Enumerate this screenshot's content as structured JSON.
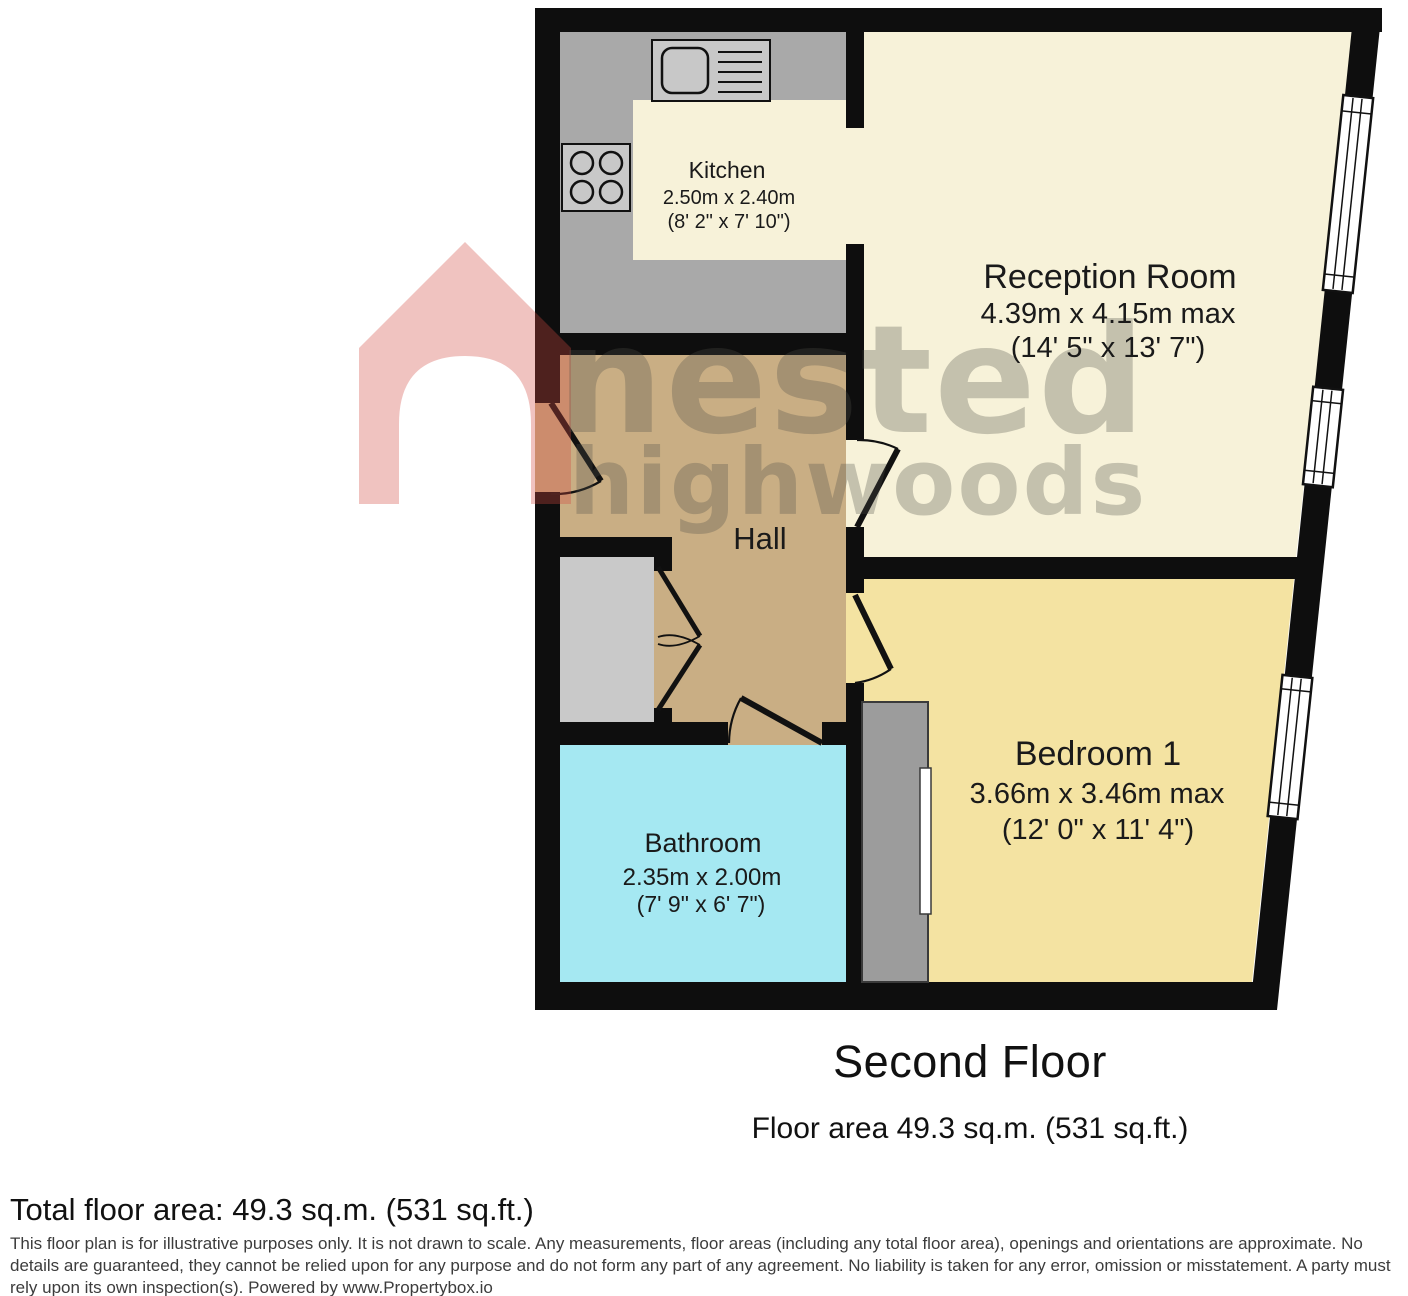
{
  "plan": {
    "rooms": {
      "kitchen": {
        "name": "Kitchen",
        "metric": "2.50m x 2.40m",
        "imperial": "(8' 2\" x 7' 10\")",
        "fill": "#f7f2d9"
      },
      "reception": {
        "name": "Reception Room",
        "metric": "4.39m x 4.15m max",
        "imperial": "(14' 5\" x 13' 7\")",
        "fill": "#f7f2d9"
      },
      "hall": {
        "name": "Hall",
        "fill": "#c9ae84"
      },
      "bedroom": {
        "name": "Bedroom 1",
        "metric": "3.66m x 3.46m max",
        "imperial": "(12' 0\" x 11' 4\")",
        "fill": "#f4e3a2"
      },
      "bathroom": {
        "name": "Bathroom",
        "metric": "2.35m x 2.00m",
        "imperial": "(7' 9\" x 6' 7\")",
        "fill": "#a5e8f2"
      }
    },
    "colors": {
      "wall": "#0e0e0e",
      "counter_gray": "#a9a9a9",
      "appliance_gray": "#c8c8c8",
      "closet_gray": "#c9c9c9",
      "wardrobe_gray": "#9c9c9c",
      "watermark_red": "#d14941",
      "watermark_gray": "#50504a"
    }
  },
  "watermark": {
    "line1": "nested",
    "line2": "highwoods"
  },
  "footer": {
    "title": "Second Floor",
    "floor_area": "Floor area 49.3 sq.m. (531 sq.ft.)",
    "total": "Total floor area: 49.3 sq.m. (531 sq.ft.)",
    "disclaimer": "This floor plan is for illustrative purposes only. It is not drawn to scale. Any measurements, floor areas (including any total floor area), openings and orientations are approximate. No details are guaranteed, they cannot be relied upon for any purpose and do not form any part of any agreement. No liability is taken for any error, omission or misstatement. A party must rely upon its own inspection(s). Powered by www.Propertybox.io"
  }
}
